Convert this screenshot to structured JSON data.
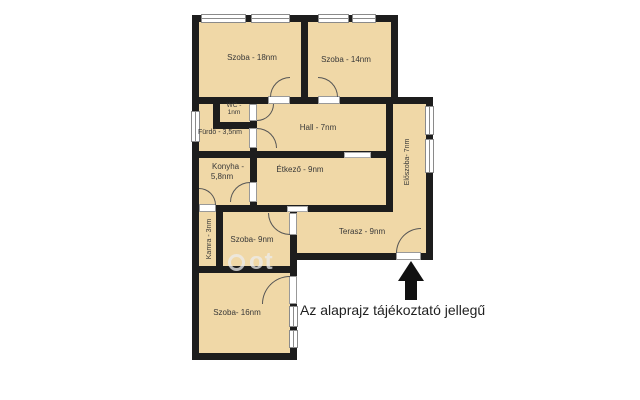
{
  "colors": {
    "room_fill": "#f0d8a7",
    "wall": "#1d1d1d",
    "window_frame": "#8a8a8a",
    "arc": "#555555",
    "text": "#383838",
    "disclaimer_text": "#1f1f1f",
    "arrow": "#111111",
    "watermark": "rgba(236,236,236,0.75)"
  },
  "rooms": {
    "szoba18": {
      "label": "Szoba - 18nm"
    },
    "szoba14": {
      "label": "Szoba - 14nm"
    },
    "wc": {
      "line1": "WC -",
      "line2": "1nm"
    },
    "furdo": {
      "label": "Fürdő - 3,5nm"
    },
    "hall": {
      "label": "Hall - 7nm"
    },
    "konyha": {
      "line1": "Konyha -",
      "line2": "5,8nm"
    },
    "etkezo": {
      "label": "Étkező - 9nm"
    },
    "eloszoba": {
      "label": "Előszoba- 7nm"
    },
    "kamra": {
      "label": "Kamra - 3nm"
    },
    "szoba9": {
      "label": "Szoba- 9nm"
    },
    "terasz": {
      "label": "Terasz - 9nm"
    },
    "szoba16": {
      "label": "Szoba- 16nm"
    }
  },
  "annotations": {
    "disclaimer": "Az alaprajz tájékoztató jellegű",
    "watermark_text": "ot"
  }
}
